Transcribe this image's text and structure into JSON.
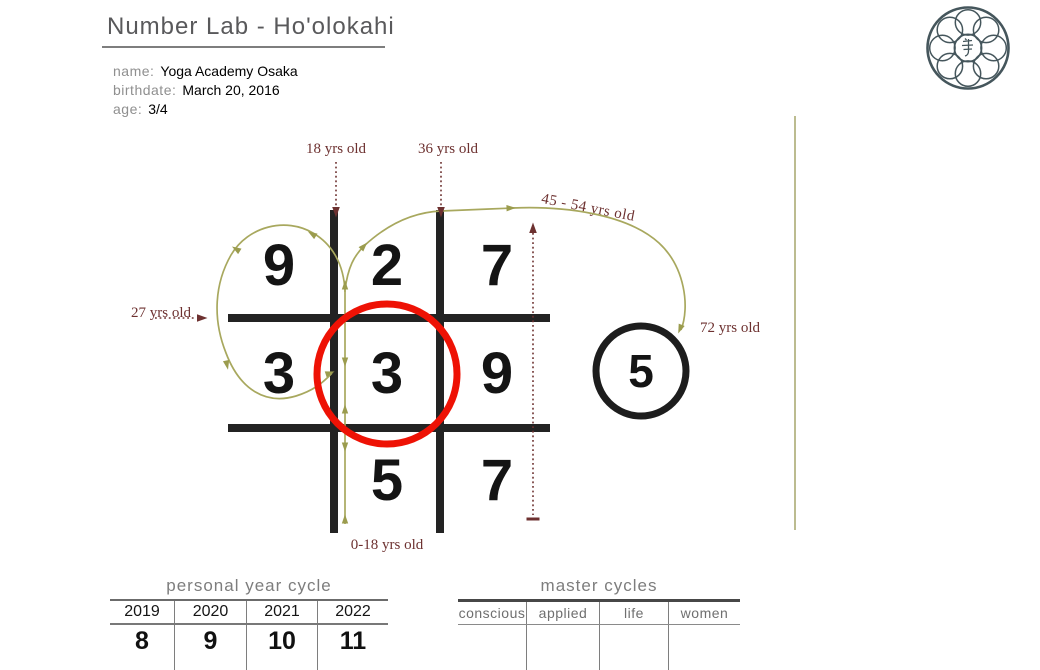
{
  "header": {
    "title": "Number Lab - Ho'olokahi",
    "fields": [
      {
        "label": "name:",
        "value": "Yoga Academy Osaka"
      },
      {
        "label": "birthdate:",
        "value": "March 20, 2016"
      },
      {
        "label": "age:",
        "value": "3/4"
      }
    ]
  },
  "logo": {
    "icon": "eight-petal-seal"
  },
  "diagram": {
    "grid": [
      [
        "9",
        "2",
        "7"
      ],
      [
        "3",
        "3",
        "9"
      ],
      [
        "",
        "5",
        "7"
      ]
    ],
    "outside_value": "5",
    "red_circle_cell": "middle-center",
    "annotations": {
      "age_18": "18 yrs old",
      "age_36": "36 yrs old",
      "age_45_54": "45 - 54 yrs old",
      "age_72": "72 yrs old",
      "age_27": "27 yrs old",
      "age_0_18": "0-18 yrs old"
    }
  },
  "tables": {
    "personal": {
      "title": "personal year cycle",
      "columns": [
        "2019",
        "2020",
        "2021",
        "2022"
      ],
      "values": [
        "8",
        "9",
        "10",
        "11"
      ]
    },
    "master": {
      "title": "master cycles",
      "columns": [
        "conscious",
        "applied",
        "life",
        "women"
      ],
      "values": [
        "",
        "",
        "",
        ""
      ]
    }
  },
  "colors": {
    "olive": "#a8a85e",
    "maroon": "#6d3130",
    "red": "#ee1205",
    "grid_black": "#232323"
  }
}
